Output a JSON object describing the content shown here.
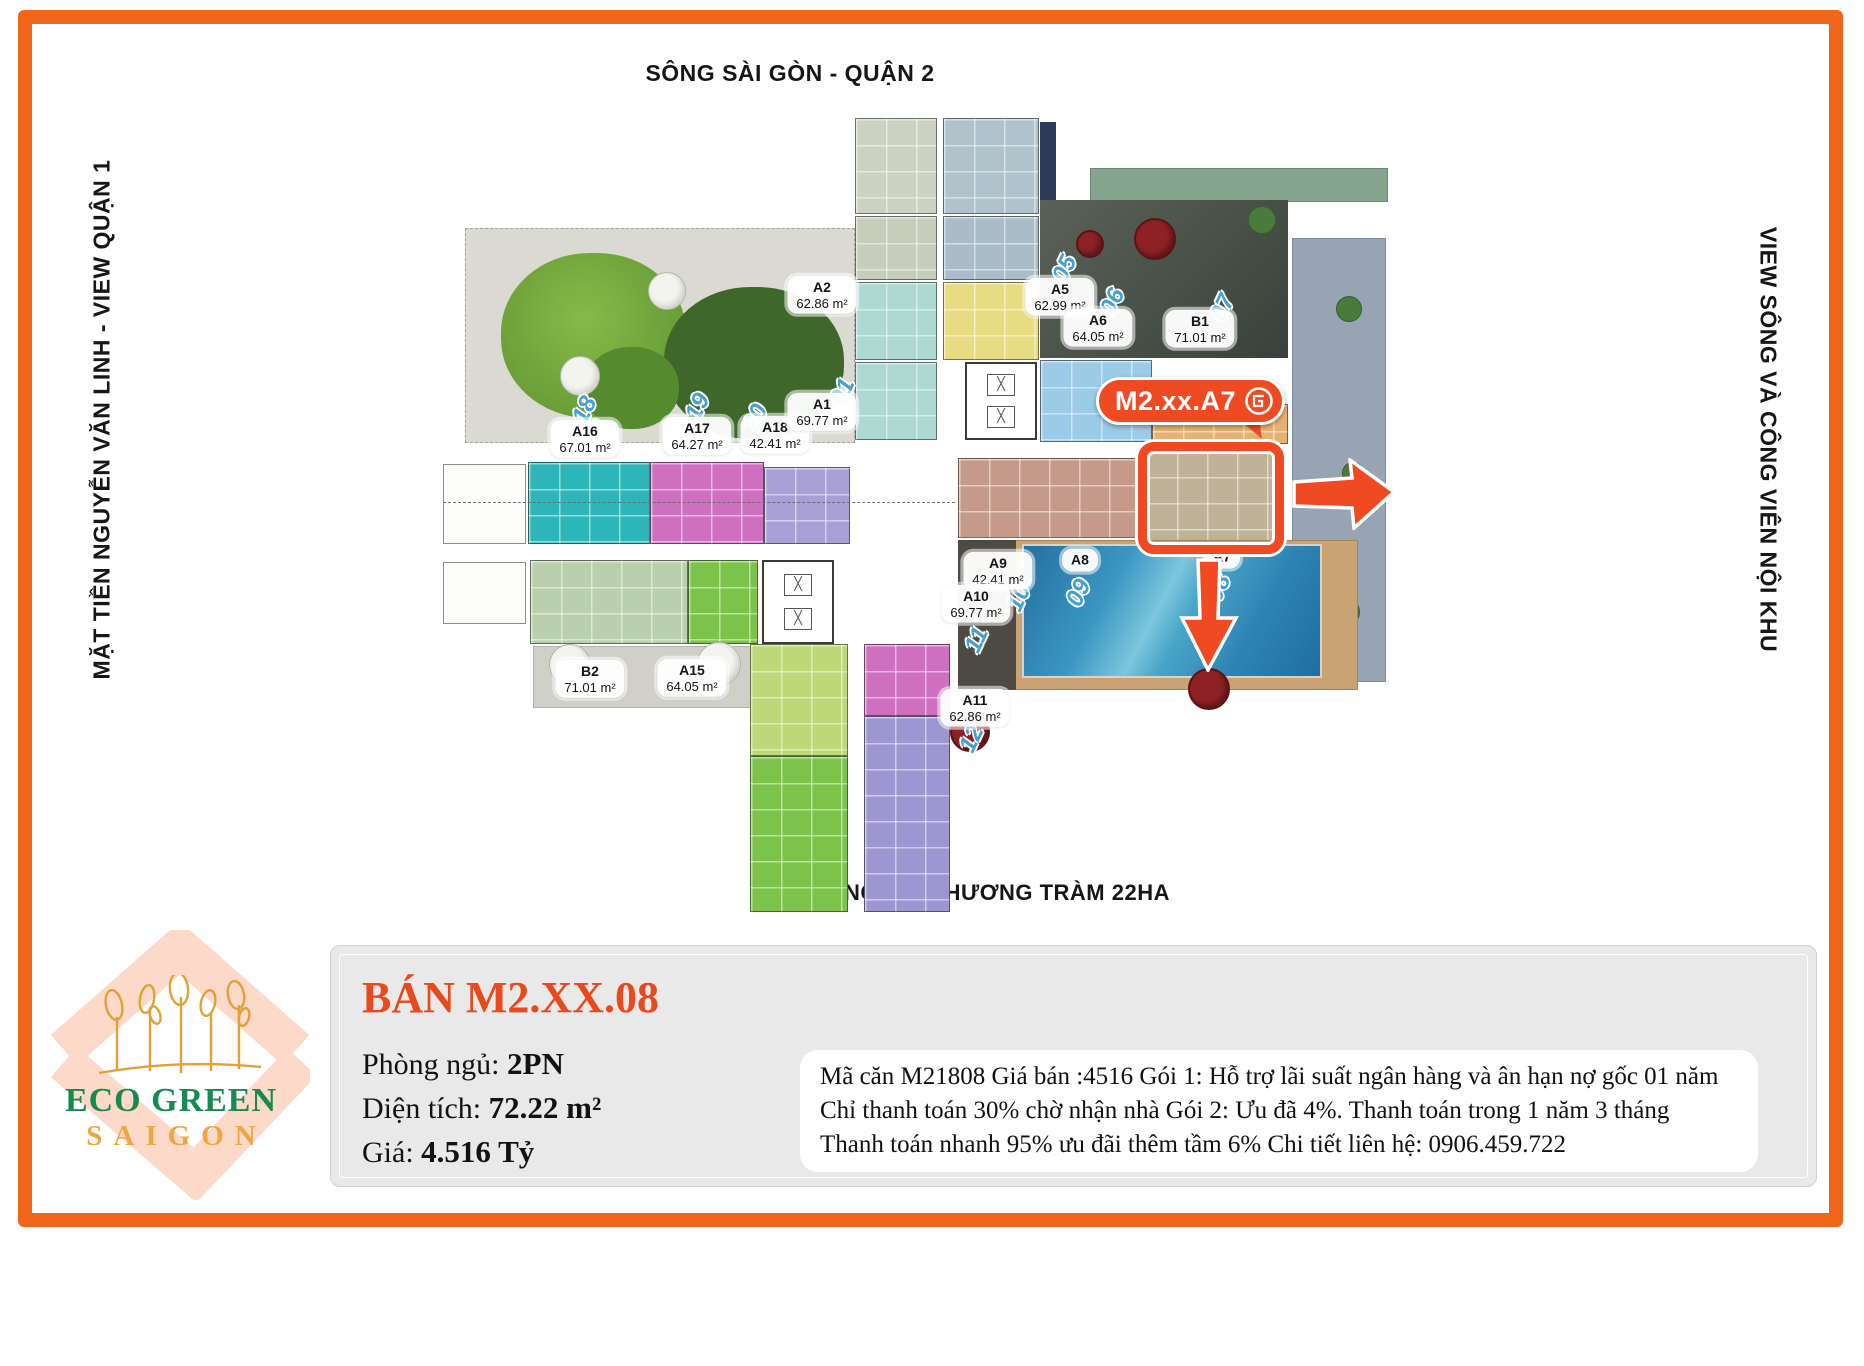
{
  "colors": {
    "frame": "#f2661c",
    "badge": "#f04a22",
    "title": "#e8491d",
    "logo_green": "#178a4f",
    "logo_gold": "#efa63f",
    "floor_number_blue": "#45a0ce"
  },
  "captions": {
    "top": "SÔNG SÀI GÒN - QUẬN 2",
    "left": "MẶT TIỀN NGUYỄN VĂN LINH - VIEW QUẬN 1",
    "right": "VIEW SÔNG VÀ CÔNG VIÊN NỘI KHU",
    "bottom": "CÔNG VIÊN HƯƠNG TRÀM 22HA"
  },
  "plan": {
    "highlight_badge": "M2.xx.A7",
    "units": [
      {
        "name": "A2",
        "area": "62.86 m²",
        "x": 822,
        "y": 295
      },
      {
        "name": "A5",
        "area": "62.99 m²",
        "x": 1060,
        "y": 297
      },
      {
        "name": "A6",
        "area": "64.05 m²",
        "x": 1098,
        "y": 328
      },
      {
        "name": "B1",
        "area": "71.01 m²",
        "x": 1200,
        "y": 329
      },
      {
        "name": "A16",
        "area": "67.01 m²",
        "x": 585,
        "y": 439
      },
      {
        "name": "A17",
        "area": "64.27 m²",
        "x": 697,
        "y": 436
      },
      {
        "name": "A18",
        "area": "42.41 m²",
        "x": 775,
        "y": 435
      },
      {
        "name": "A1",
        "area": "69.77 m²",
        "x": 822,
        "y": 412
      },
      {
        "name": "A9",
        "area": "42.41 m²",
        "x": 998,
        "y": 571
      },
      {
        "name": "A10",
        "area": "69.77 m²",
        "x": 976,
        "y": 604
      },
      {
        "name": "A8",
        "area": "",
        "x": 1080,
        "y": 560
      },
      {
        "name": "A7",
        "area": "",
        "x": 1222,
        "y": 557
      },
      {
        "name": "A11",
        "area": "62.86 m²",
        "x": 975,
        "y": 708
      },
      {
        "name": "B2",
        "area": "71.01 m²",
        "x": 590,
        "y": 679
      },
      {
        "name": "A15",
        "area": "64.05 m²",
        "x": 692,
        "y": 678
      }
    ],
    "floor_numbers": [
      {
        "n": "18",
        "x": 585,
        "y": 410
      },
      {
        "n": "19",
        "x": 698,
        "y": 407
      },
      {
        "n": "20",
        "x": 756,
        "y": 418
      },
      {
        "n": "01",
        "x": 843,
        "y": 392
      },
      {
        "n": "05",
        "x": 1065,
        "y": 269
      },
      {
        "n": "06",
        "x": 1113,
        "y": 302
      },
      {
        "n": "07",
        "x": 1223,
        "y": 308
      },
      {
        "n": "08",
        "x": 1219,
        "y": 588
      },
      {
        "n": "09",
        "x": 1079,
        "y": 593
      },
      {
        "n": "10",
        "x": 1019,
        "y": 598
      },
      {
        "n": "11",
        "x": 977,
        "y": 640
      },
      {
        "n": "12",
        "x": 972,
        "y": 739
      }
    ]
  },
  "listing": {
    "title": "BÁN M2.XX.08",
    "bedrooms_label": "Phòng ngủ:",
    "bedrooms_value": "2PN",
    "area_label": "Diện tích:",
    "area_value": "72.22 m²",
    "price_label": "Giá:",
    "price_value": "4.516 Tỷ",
    "description": "Mã căn M21808 Giá bán :4516 Gói 1: Hỗ trợ lãi suất ngân hàng và ân hạn nợ gốc 01 năm Chỉ thanh toán 30% chờ nhận nhà Gói 2: Ưu đã 4%. Thanh toán trong 1 năm 3 tháng Thanh toán nhanh 95% ưu đãi thêm tầm 6% Chi tiết liên hệ: 0906.459.722"
  },
  "logo": {
    "line1": "ECO GREEN",
    "line2": "SAIGON"
  }
}
